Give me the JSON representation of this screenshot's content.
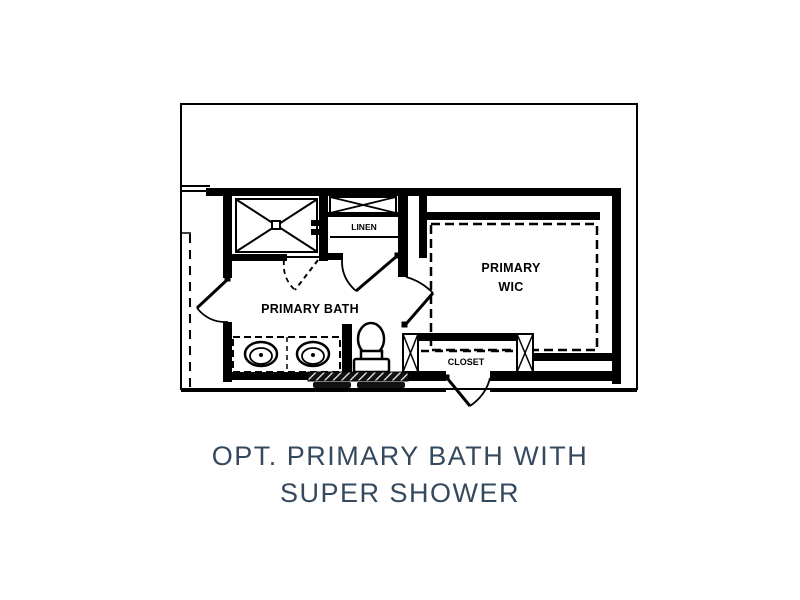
{
  "page": {
    "background_color": "#ffffff"
  },
  "floorplan": {
    "ink_color": "#000000",
    "rooms": {
      "bath": {
        "label": "PRIMARY BATH"
      },
      "wic": {
        "label_line1": "PRIMARY",
        "label_line2": "WIC"
      },
      "linen": {
        "label": "LINEN"
      },
      "closet": {
        "label": "CLOSET"
      }
    },
    "fixture_icons": [
      "shower-icon",
      "shower-glass-door-icon",
      "linen-shelf-x-icon",
      "double-vanity-sinks-icon",
      "toilet-icon",
      "wic-shelving-dashed-icon",
      "closet-shelf-dashed-icon",
      "closet-post-x-icon",
      "door-swing-icon",
      "window-panel-icon",
      "hatched-wall-icon"
    ]
  },
  "caption": {
    "line1": "OPT. PRIMARY BATH WITH",
    "line2": "SUPER SHOWER",
    "color": "#35495e"
  }
}
